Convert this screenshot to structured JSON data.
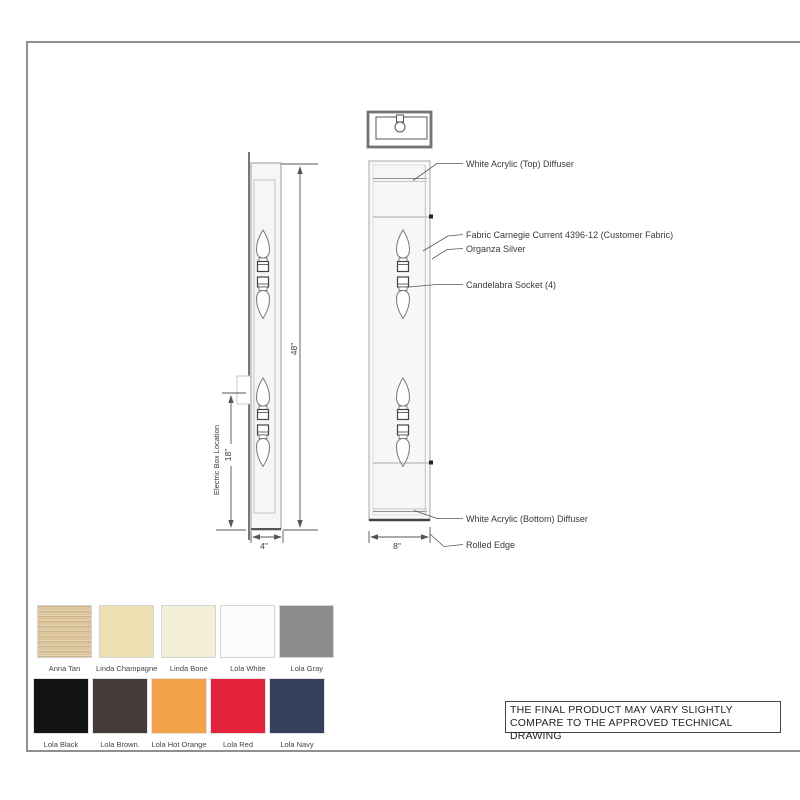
{
  "drawing": {
    "annotations": {
      "top_diffuser": "White Acrylic (Top) Diffuser",
      "fabric": "Fabric Carnegie Current 4396-12 (Customer Fabric)",
      "organza": "Organza Silver",
      "socket": "Candelabra Socket (4)",
      "bottom_diffuser": "White Acrylic (Bottom) Diffuser",
      "rolled_edge": "Rolled Edge",
      "electric_box": "Electric Box Location"
    },
    "dimensions": {
      "height": "48\"",
      "electric_box_height": "18\"",
      "side_depth": "4\"",
      "front_width": "8\""
    }
  },
  "swatches": {
    "row1": [
      {
        "name": "Anna Tan",
        "color": "#dcc49c"
      },
      {
        "name": "Linda Champagne",
        "color": "#eddfb1"
      },
      {
        "name": "Linda Bone",
        "color": "#f3eed8"
      },
      {
        "name": "Lola White",
        "color": "#fcfcfc"
      },
      {
        "name": "Lola Gray",
        "color": "#8e8b8b"
      }
    ],
    "row2": [
      {
        "name": "Lola Black",
        "color": "#131313"
      },
      {
        "name": "Lola Brown.",
        "color": "#453a38"
      },
      {
        "name": "Lola Hot Orange",
        "color": "#f4a14c"
      },
      {
        "name": "Lola Red",
        "color": "#e4213b"
      },
      {
        "name": "Lola Navy",
        "color": "#36405a"
      }
    ]
  },
  "note": {
    "line1": "THE FINAL PRODUCT  MAY VARY SLIGHTLY",
    "line2": "COMPARE TO THE APPROVED TECHNICAL DRAWING"
  }
}
